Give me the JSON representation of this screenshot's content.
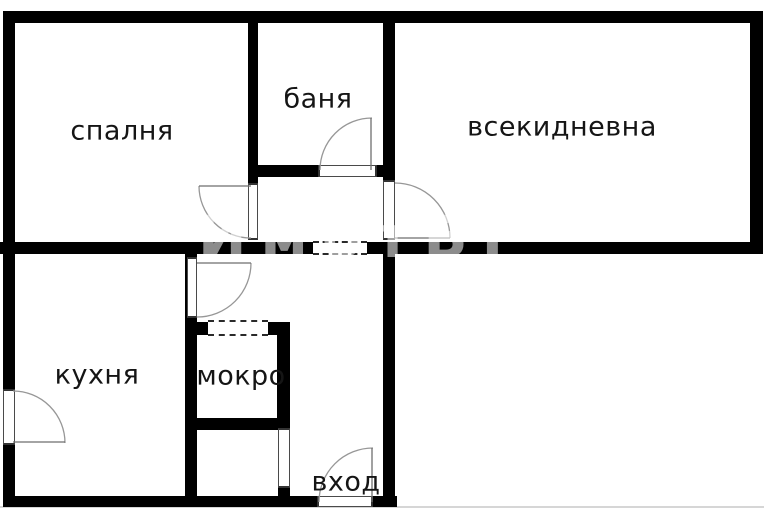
{
  "plan": {
    "canvas": {
      "width": 764,
      "height": 510,
      "background": "#ffffff"
    },
    "colors": {
      "wall": "#000000",
      "label": "#151515",
      "door_arc": "#979797",
      "door_frame": "#4a4a4a"
    },
    "rooms": [
      {
        "id": "bedroom",
        "label": "спалня"
      },
      {
        "id": "bathroom",
        "label": "баня"
      },
      {
        "id": "living-room",
        "label": "всекидневна"
      },
      {
        "id": "kitchen",
        "label": "кухня"
      },
      {
        "id": "utility",
        "label": "мокро"
      },
      {
        "id": "entrance",
        "label": "вход"
      }
    ],
    "watermark": {
      "text": "ИмотБГ"
    }
  }
}
